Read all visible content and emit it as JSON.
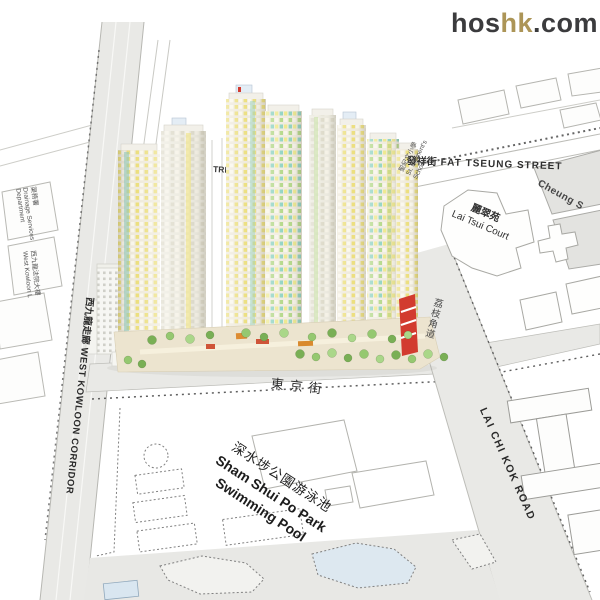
{
  "logo": {
    "part1": "hos",
    "part2": "hk",
    "part3": ".com",
    "color_dark": "#3b3b3d",
    "color_gold": "#ac9557"
  },
  "map": {
    "roads": {
      "west_kowloon_corridor_zh": "西九龍走廊",
      "west_kowloon_corridor_en": "WEST KOWLOON CORRIDOR",
      "fat_tseung_street_zh": "發祥街",
      "fat_tseung_street_en": "FAT TSEUNG STREET",
      "tonkin_street_zh": "東京街",
      "lai_chi_kok_road_zh": "荔枝角道",
      "lai_chi_kok_road_en": "LAI CHI KOK ROAD",
      "street_fragment": "TREET"
    },
    "places": {
      "lai_tsui_court_zh": "麗翠苑",
      "lai_tsui_court_en": "Lai Tsui Court",
      "cheung_partial": "Cheung S",
      "pool_zh": "深水埗公園游泳池",
      "pool_en1": "Sham Shui Po Park",
      "pool_en2": "Swimming Pool",
      "school_zh": "聖紀文小學",
      "school_en1": "St. Clement's",
      "school_en2": "School",
      "drainage_zh": "渠務署",
      "drainage_en1": "Drainage Services",
      "drainage_en2": "Department",
      "law_courts_zh": "西九龍法院大樓",
      "law_courts_en": "West Kowloon L"
    },
    "colors": {
      "road_fill": "#e9e9e6",
      "line": "#b2b2ad",
      "window_yellow": "#ecdf7e",
      "window_green": "#b3d887",
      "window_teal": "#8ed2c2",
      "accent_red": "#d23b2f",
      "tree_green": "#84ba60",
      "pool_blue": "#d9e6f0"
    }
  }
}
